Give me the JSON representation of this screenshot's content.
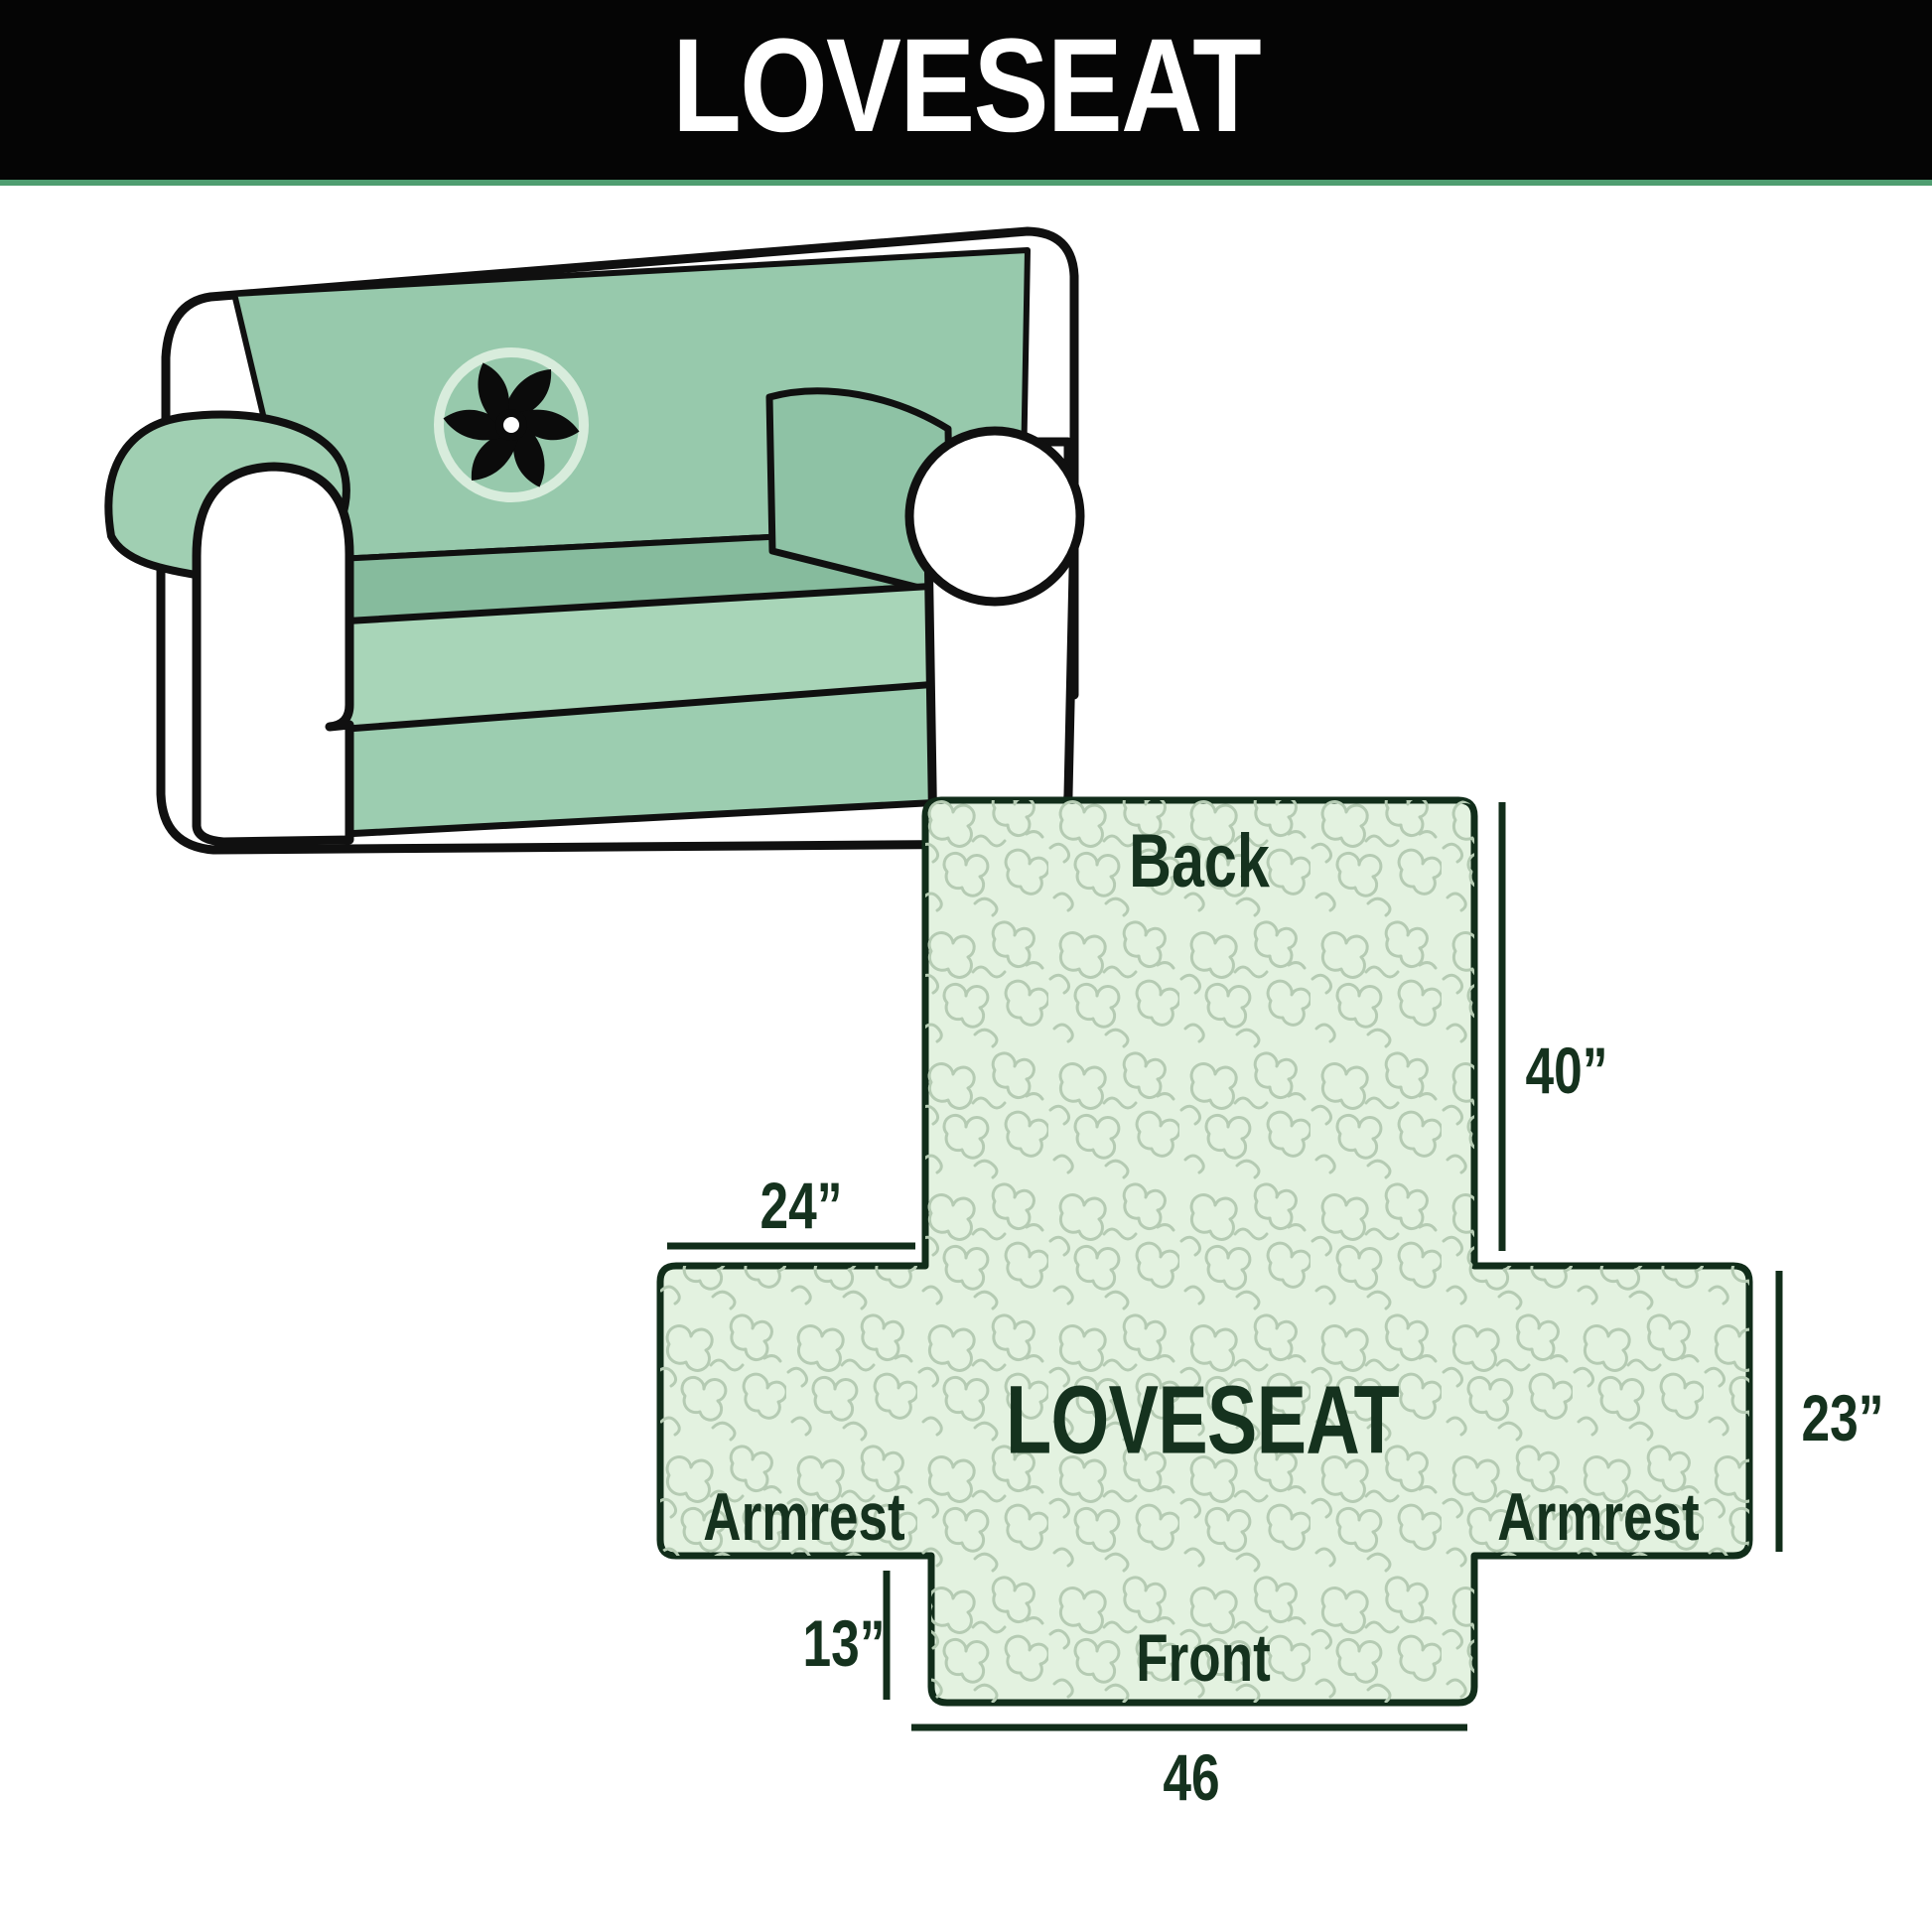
{
  "header": {
    "title": "LOVESEAT"
  },
  "illustration": {
    "icon": "pinwheel-icon",
    "subject": "loveseat sofa with slipcover"
  },
  "diagram": {
    "labels": {
      "back": "Back",
      "front": "Front",
      "armrest_left": "Armrest",
      "armrest_right": "Armrest",
      "center": "LOVESEAT"
    },
    "dimensions": {
      "back_height": "40”",
      "armrest_flap_width": "24”",
      "side_height": "23”",
      "front_flap_height": "13”",
      "seat_width": "46"
    }
  },
  "colors": {
    "header_bg": "#050505",
    "header_text": "#ffffff",
    "header_accent_line": "#4f9e71",
    "cover_green": "#97c9ac",
    "diagram_fill": "#e3f2e0",
    "squiggle": "#b5cbb3",
    "line_dark": "#112d1a",
    "label_text": "#15321e",
    "outline_black": "#101010"
  }
}
